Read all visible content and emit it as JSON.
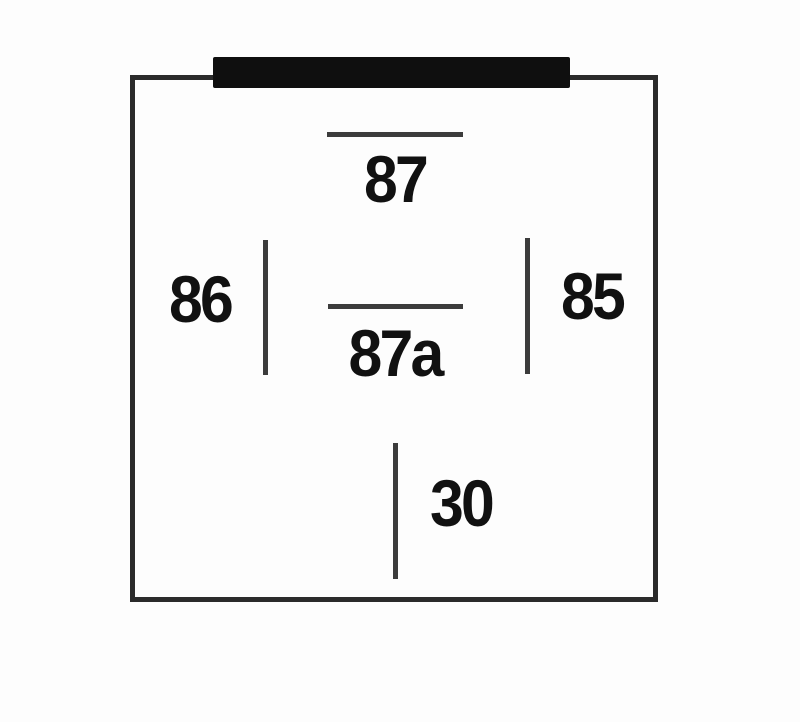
{
  "diagram": {
    "kind": "relay-pinout-diagram",
    "colors": {
      "background": "#fdfdfd",
      "box_border": "#2b2b2b",
      "connector_bar": "#0f0f0f",
      "pin_line": "#3c3c3c",
      "label_text": "#111111"
    },
    "pins": [
      {
        "label": "87",
        "symbol": "horizontal-line",
        "position": "top-center"
      },
      {
        "label": "86",
        "symbol": "vertical-line",
        "position": "middle-left"
      },
      {
        "label": "85",
        "symbol": "vertical-line",
        "position": "middle-right"
      },
      {
        "label": "87a",
        "symbol": "horizontal-line",
        "position": "center"
      },
      {
        "label": "30",
        "symbol": "vertical-line",
        "position": "bottom-center"
      }
    ]
  }
}
